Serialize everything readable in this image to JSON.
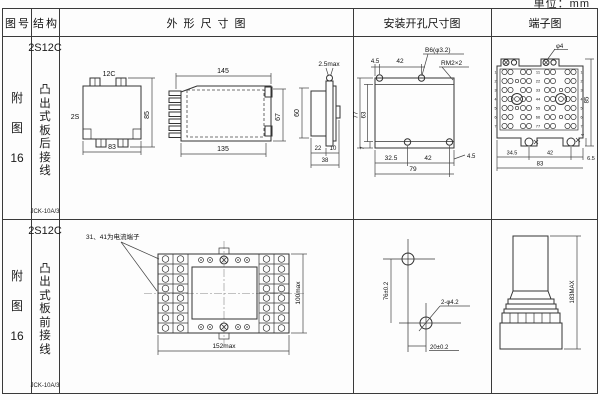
{
  "unit_label": "单位：mm",
  "header": {
    "fig_no": "图号",
    "structure": "结构",
    "outline": "外形尺寸图",
    "install": "安装开孔尺寸图",
    "terminal": "端子图"
  },
  "rows": [
    {
      "fig_char1": "附",
      "fig_char2": "图",
      "fig_num": "16",
      "model": "2S12C",
      "structure": "凸出式板后接线",
      "code": "JCK-10A/3",
      "outline": {
        "front_top": "12C",
        "front_side": "2S",
        "front_width": "83",
        "front_height": "85",
        "side_top": "145",
        "side_bottom": "135",
        "side_height": "67",
        "end_top": "2.5max",
        "end_height": "60",
        "end_d1": "22",
        "end_d2": "10",
        "end_total": "38"
      },
      "install": {
        "top_d1": "4.5",
        "top_d2": "42",
        "callout_hole": "B6(φ3.2)",
        "callout_thread": "RM2×2",
        "left_outer": "77",
        "left_inner": "63",
        "bottom_left": "7",
        "bottom_d1": "32.5",
        "bottom_d2": "42",
        "bottom_d3": "4.5",
        "bottom_total": "79"
      },
      "terminal": {
        "callout": "φ4",
        "height": "85",
        "foot": "4",
        "bottom_d1": "34.5",
        "bottom_d2": "42",
        "bottom_d3": "6.5",
        "bottom_total": "83",
        "row_labels": [
          "1",
          "2",
          "3",
          "4",
          "5",
          "6",
          "7"
        ],
        "pair_labels": [
          "11",
          "22",
          "33",
          "44",
          "55",
          "66",
          "77"
        ]
      }
    },
    {
      "fig_char1": "附",
      "fig_char2": "图",
      "fig_num": "16",
      "model": "2S12C",
      "structure": "凸出式板前接线",
      "code": "JCK-10A/3",
      "outline": {
        "note": "31、41为电流端子",
        "width": "152max",
        "height": "100max"
      },
      "install": {
        "vertical": "76±0.2",
        "horizontal": "20±0.2",
        "callout": "2-φ4.2"
      },
      "terminal": {
        "height": "183MAX"
      }
    }
  ]
}
